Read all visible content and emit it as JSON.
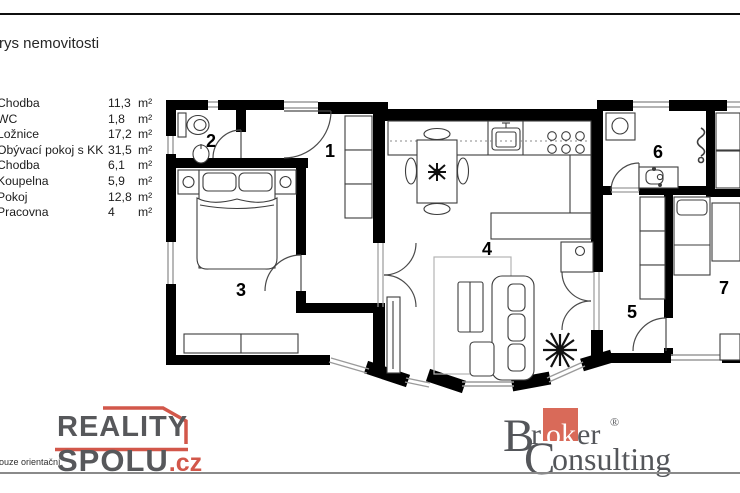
{
  "page": {
    "title": "rys nemovitosti"
  },
  "legend": {
    "rows": [
      {
        "name": "Chodba",
        "area": "11,3",
        "unit": "m²"
      },
      {
        "name": "WC",
        "area": "1,8",
        "unit": "m²"
      },
      {
        "name": "Ložnice",
        "area": "17,2",
        "unit": "m²"
      },
      {
        "name": "Obývací pokoj s KK",
        "area": "31,5",
        "unit": "m²"
      },
      {
        "name": "Chodba",
        "area": "6,1",
        "unit": "m²"
      },
      {
        "name": "Koupelna",
        "area": "5,9",
        "unit": "m²"
      },
      {
        "name": "Pokoj",
        "area": "12,8",
        "unit": "m²"
      },
      {
        "name": "Pracovna",
        "area": "4",
        "unit": "m²"
      }
    ]
  },
  "floorplan": {
    "rooms": [
      {
        "number": "1"
      },
      {
        "number": "2"
      },
      {
        "number": "3"
      },
      {
        "number": "4"
      },
      {
        "number": "5"
      },
      {
        "number": "6"
      },
      {
        "number": "7"
      }
    ]
  },
  "footer": {
    "disclaimer": "pouze orientační",
    "reality_spolu": {
      "word1": "REALITY",
      "word2": "SPOLU",
      "tld": ".cz"
    },
    "broker": {
      "b": "B",
      "r": "r",
      "ok": "ok",
      "er": "er",
      "reg": "®",
      "c": "C",
      "onsulting": "onsulting"
    }
  },
  "colors": {
    "wall": "#000000",
    "window": "#9a9a9a",
    "accent_red": "#d2574a",
    "broker_red": "#d96a59",
    "logo_gray": "#57585b",
    "broker_gray": "#54565a"
  }
}
